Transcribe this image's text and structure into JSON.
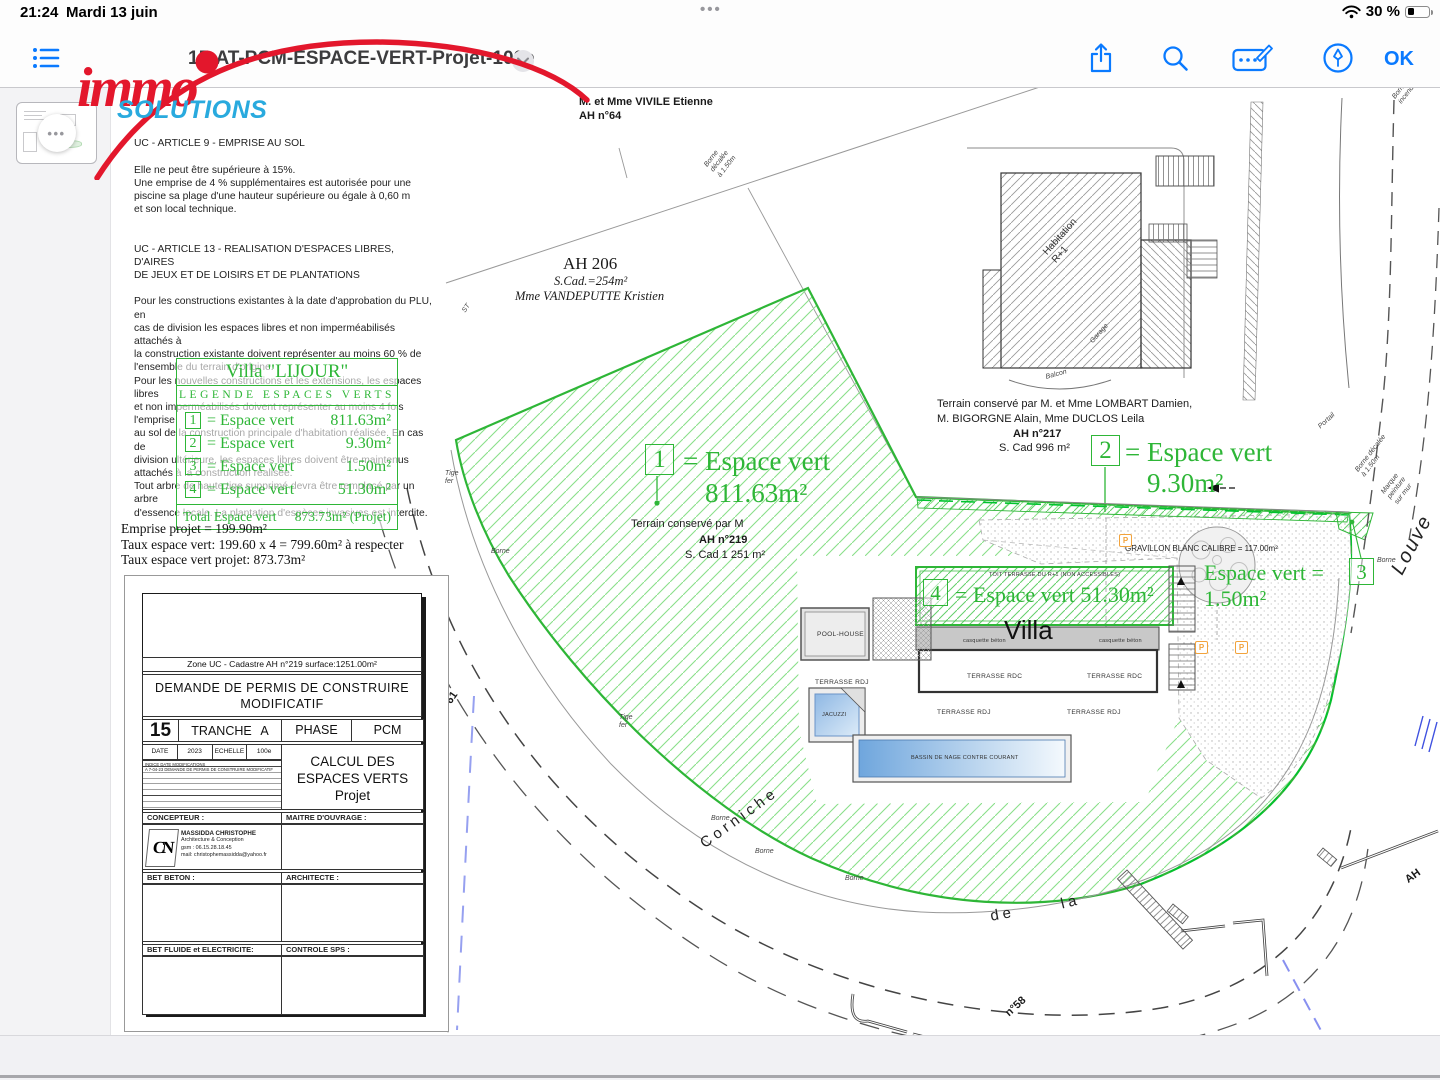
{
  "status_bar": {
    "time": "21:24",
    "date": "Mardi 13 juin",
    "dots": "•••",
    "battery_pct": "30 %"
  },
  "toolbar": {
    "title": "15-AT-PCM-ESPACE-VERT-Projet-100e",
    "ok_label": "OK"
  },
  "logo": {
    "word1": "immo",
    "word2": "SOLUTIONS"
  },
  "sidebar": {
    "thumb_dots": "•••"
  },
  "colors": {
    "accent": "#0a7aff",
    "green": "#2eb637",
    "logo_red": "#e3172c",
    "logo_blue": "#29aade",
    "p_orange": "#f2a33c"
  },
  "doc": {
    "articles": {
      "a9_title": "UC - ARTICLE 9 - EMPRISE AU SOL",
      "a9_body": "Elle ne peut être supérieure à 15%.\nUne emprise de 4 % supplémentaires est autorisée pour une\npiscine sa plage d'une hauteur supérieure ou égale à 0,60 m\net son local technique.",
      "a13_title": "UC - ARTICLE 13 - REALISATION D'ESPACES LIBRES, D'AIRES\nDE JEUX ET DE LOISIRS ET DE PLANTATIONS",
      "a13_body": "Pour les constructions existantes à la date d'approbation du PLU, en\ncas de division les espaces libres et non imperméabilisés attachés à\nla construction existante doivent représenter au moins 60 % de\nl'ensemble du terrain d'origine.\nPour les nouvelles constructions et les extensions, les espaces libres\net non imperméabilisés doivent représenter au moins 4 fois l'emprise\nau sol de la construction principale d'habitation réalisée. En cas de\ndivision ultérieure, les espaces libres doivent être maintenus\nattachés à la construction réalisée.\nTout arbre de haute tige supprimé devra être remplacé par un arbre\nd'essence locale. La plantation d'espèces invasives est interdite."
    },
    "legend": {
      "title": "Villa  \"LIJOUR\"",
      "subtitle": "LEGENDE ESPACES VERTS",
      "rows": [
        {
          "num": "1",
          "label": "= Espace vert",
          "value": "811.63m²"
        },
        {
          "num": "2",
          "label": "= Espace vert",
          "value": "9.30m²"
        },
        {
          "num": "3",
          "label": "= Espace vert",
          "value": "1.50m²"
        },
        {
          "num": "4",
          "label": "= Espace vert",
          "value": "51.30m²"
        }
      ],
      "total_label": "Total Espace vert",
      "total_value": "873.73m² (Projet)"
    },
    "emprise": [
      "Emprise projet = 199.90m²",
      "Taux espace vert: 199.60 x 4 = 799.60m² à respecter",
      "Taux espace vert projet: 873.73m²"
    ],
    "cartouche": {
      "zone": "Zone UC - Cadastre AH n°219  surface:1251.00m²",
      "demande": "DEMANDE DE PERMIS DE CONSTRUIRE\nMODIFICATIF",
      "num": "15",
      "tranche_label": "TRANCHE",
      "tranche_val": "A",
      "phase_label": "PHASE",
      "phase_val": "PCM",
      "date_label": "DATE",
      "date_val": "2023",
      "echelle_label": "ECHELLE",
      "echelle_val": "100e",
      "mod_head": "INDICE   DATE   MODIFICATIONS",
      "mod_row": "A   7-04-23   DEMANDE DE PERMIS DE CONSTRUIRE MODIFICATIF",
      "calcul": "CALCUL DES\nESPACES VERTS\nProjet",
      "concepteur_label": "CONCEPTEUR :",
      "moa_label": "MAITRE D'OUVRAGE :",
      "cn": "CN",
      "concepteur_name": "MASSIDDA CHRISTOPHE",
      "concepteur_l2": "Architecture & Conception",
      "concepteur_l3": "gsm : 06.15.28.18.45",
      "concepteur_l4": "mail: christophemassidda@yahoo.fr",
      "bet_beton": "BET BETON :",
      "architecte": "ARCHITECTE :",
      "bet_fluide": "BET FLUIDE et ELECTRICITE:",
      "controle": "CONTROLE SPS :"
    }
  },
  "plan": {
    "annotations": [
      {
        "t": "M. et Mme VIVILE Etienne",
        "x": 468,
        "y": 8,
        "s": "plan-b"
      },
      {
        "t": "AH n°64",
        "x": 468,
        "y": 22,
        "s": "plan-b"
      },
      {
        "t": "Borne\ndécalée\nà 1.50m",
        "x": 592,
        "y": 76,
        "s": "tiny-i",
        "r": -52
      },
      {
        "t": "AH 206",
        "x": 452,
        "y": 166,
        "s": "serif-lg"
      },
      {
        "t": "S.Cad.=254m²",
        "x": 443,
        "y": 186,
        "s": "serif-i"
      },
      {
        "t": "Mme VANDEPUTTE Kristien",
        "x": 404,
        "y": 201,
        "s": "serif-i"
      },
      {
        "t": "ST",
        "x": 350,
        "y": 222,
        "s": "tiny-i",
        "r": -55
      },
      {
        "t": "Tige\nfer",
        "x": 334,
        "y": 382,
        "s": "tiny-i"
      },
      {
        "t": "Borne",
        "x": 380,
        "y": 460,
        "s": "tiny-i"
      },
      {
        "t": "Tige\nfer",
        "x": 508,
        "y": 626,
        "s": "tiny-i"
      },
      {
        "t": "Borne",
        "x": 600,
        "y": 727,
        "s": "tiny-i"
      },
      {
        "t": "Borne",
        "x": 644,
        "y": 760,
        "s": "tiny-i"
      },
      {
        "t": "Borne",
        "x": 734,
        "y": 787,
        "s": "tiny-i"
      },
      {
        "t": "Terrain conservé par M. et Mme LOMBART Damien,",
        "x": 826,
        "y": 310,
        "s": "plan"
      },
      {
        "t": "M. BIGORGNE Alain, Mme DUCLOS Leila",
        "x": 826,
        "y": 325,
        "s": "plan"
      },
      {
        "t": "AH n°217",
        "x": 902,
        "y": 340,
        "s": "plan-b"
      },
      {
        "t": "S. Cad  996 m²",
        "x": 888,
        "y": 354,
        "s": "plan"
      },
      {
        "t": "Terrain conservé par M",
        "x": 520,
        "y": 430,
        "s": "plan"
      },
      {
        "t": "AH n°219",
        "x": 588,
        "y": 446,
        "s": "plan-b"
      },
      {
        "t": "S. Cad  1 251 m²",
        "x": 574,
        "y": 461,
        "s": "plan"
      },
      {
        "t": "1",
        "x": 534,
        "y": 356,
        "s": "gbox-lg"
      },
      {
        "t": "= Espace vert",
        "x": 572,
        "y": 358,
        "s": "green-lg"
      },
      {
        "t": "811.63m²",
        "x": 594,
        "y": 390,
        "s": "green-lg"
      },
      {
        "t": "2",
        "x": 980,
        "y": 347,
        "s": "gbox-lg"
      },
      {
        "t": "= Espace vert",
        "x": 1014,
        "y": 349,
        "s": "green-lg"
      },
      {
        "t": "9.30m²",
        "x": 1036,
        "y": 380,
        "s": "green-lg"
      },
      {
        "t": "Espace vert =",
        "x": 1093,
        "y": 472,
        "s": "green-md"
      },
      {
        "t": "3",
        "x": 1238,
        "y": 470,
        "s": "gbox-md"
      },
      {
        "t": "1.50m²",
        "x": 1093,
        "y": 498,
        "s": "green-md"
      },
      {
        "t": "4",
        "x": 812,
        "y": 491,
        "s": "gbox-md"
      },
      {
        "t": "= Espace vert 51.30m²",
        "x": 844,
        "y": 494,
        "s": "green-md"
      },
      {
        "t": "TOIT TERRASSE DU R+1 (NON ACCESSIBLES)",
        "x": 878,
        "y": 484,
        "s": "micro"
      },
      {
        "t": "Villa",
        "x": 893,
        "y": 527,
        "s": "villa"
      },
      {
        "t": "casquette béton",
        "x": 852,
        "y": 550,
        "s": "micro"
      },
      {
        "t": "casquette béton",
        "x": 988,
        "y": 550,
        "s": "micro"
      },
      {
        "t": "TERRASSE RDC",
        "x": 856,
        "y": 585,
        "s": "tiny"
      },
      {
        "t": "TERRASSE RDC",
        "x": 976,
        "y": 585,
        "s": "tiny"
      },
      {
        "t": "POOL-HOUSE",
        "x": 706,
        "y": 543,
        "s": "tiny"
      },
      {
        "t": "TERRASSE RDJ",
        "x": 704,
        "y": 591,
        "s": "tiny"
      },
      {
        "t": "TERRASSE RDJ",
        "x": 826,
        "y": 621,
        "s": "tiny"
      },
      {
        "t": "TERRASSE RDJ",
        "x": 956,
        "y": 621,
        "s": "tiny"
      },
      {
        "t": "JACUZZI",
        "x": 711,
        "y": 624,
        "s": "micro"
      },
      {
        "t": "BASSIN DE NAGE CONTRE COURANT",
        "x": 800,
        "y": 667,
        "s": "micro"
      },
      {
        "t": "GRAVILLON BLANC CALIBRE = 117.00m²",
        "x": 1014,
        "y": 456,
        "s": "small"
      },
      {
        "t": "P",
        "x": 1008,
        "y": 446,
        "s": "pbox"
      },
      {
        "t": "P",
        "x": 1084,
        "y": 553,
        "s": "pbox"
      },
      {
        "t": "P",
        "x": 1124,
        "y": 553,
        "s": "pbox"
      },
      {
        "t": "Habitation\nR+1",
        "x": 930,
        "y": 162,
        "s": "rot-lbl",
        "r": -48
      },
      {
        "t": "Garage",
        "x": 978,
        "y": 252,
        "s": "tiny-i",
        "r": -48
      },
      {
        "t": "Balcon",
        "x": 934,
        "y": 286,
        "s": "tiny-i",
        "r": -15
      },
      {
        "t": "Borne\nincendie",
        "x": 1280,
        "y": 8,
        "s": "tiny-i",
        "r": -52
      },
      {
        "t": "Portail",
        "x": 1206,
        "y": 337,
        "s": "tiny-i",
        "r": -42
      },
      {
        "t": "Borne décalée\nà 1.50m",
        "x": 1243,
        "y": 381,
        "s": "tiny-i",
        "r": -52
      },
      {
        "t": "Marque\npeinture\nsur mur",
        "x": 1269,
        "y": 403,
        "s": "tiny-i",
        "r": -52
      },
      {
        "t": "Borne",
        "x": 1266,
        "y": 469,
        "s": "tiny-i"
      },
      {
        "t": "Louve",
        "x": 1276,
        "y": 480,
        "s": "street-big",
        "r": -62
      },
      {
        "t": "Corniche",
        "x": 586,
        "y": 750,
        "s": "street",
        "r": -36
      },
      {
        "t": "de",
        "x": 878,
        "y": 820,
        "s": "street",
        "r": -10
      },
      {
        "t": "la",
        "x": 948,
        "y": 808,
        "s": "street",
        "r": -14
      },
      {
        "t": "AH",
        "x": 1292,
        "y": 788,
        "s": "plan-b",
        "r": -36
      },
      {
        "t": "n°58",
        "x": 892,
        "y": 922,
        "s": "plan-b",
        "r": -42
      },
      {
        "t": "°61",
        "x": 330,
        "y": 615,
        "s": "plan-b",
        "r": -55
      }
    ]
  }
}
